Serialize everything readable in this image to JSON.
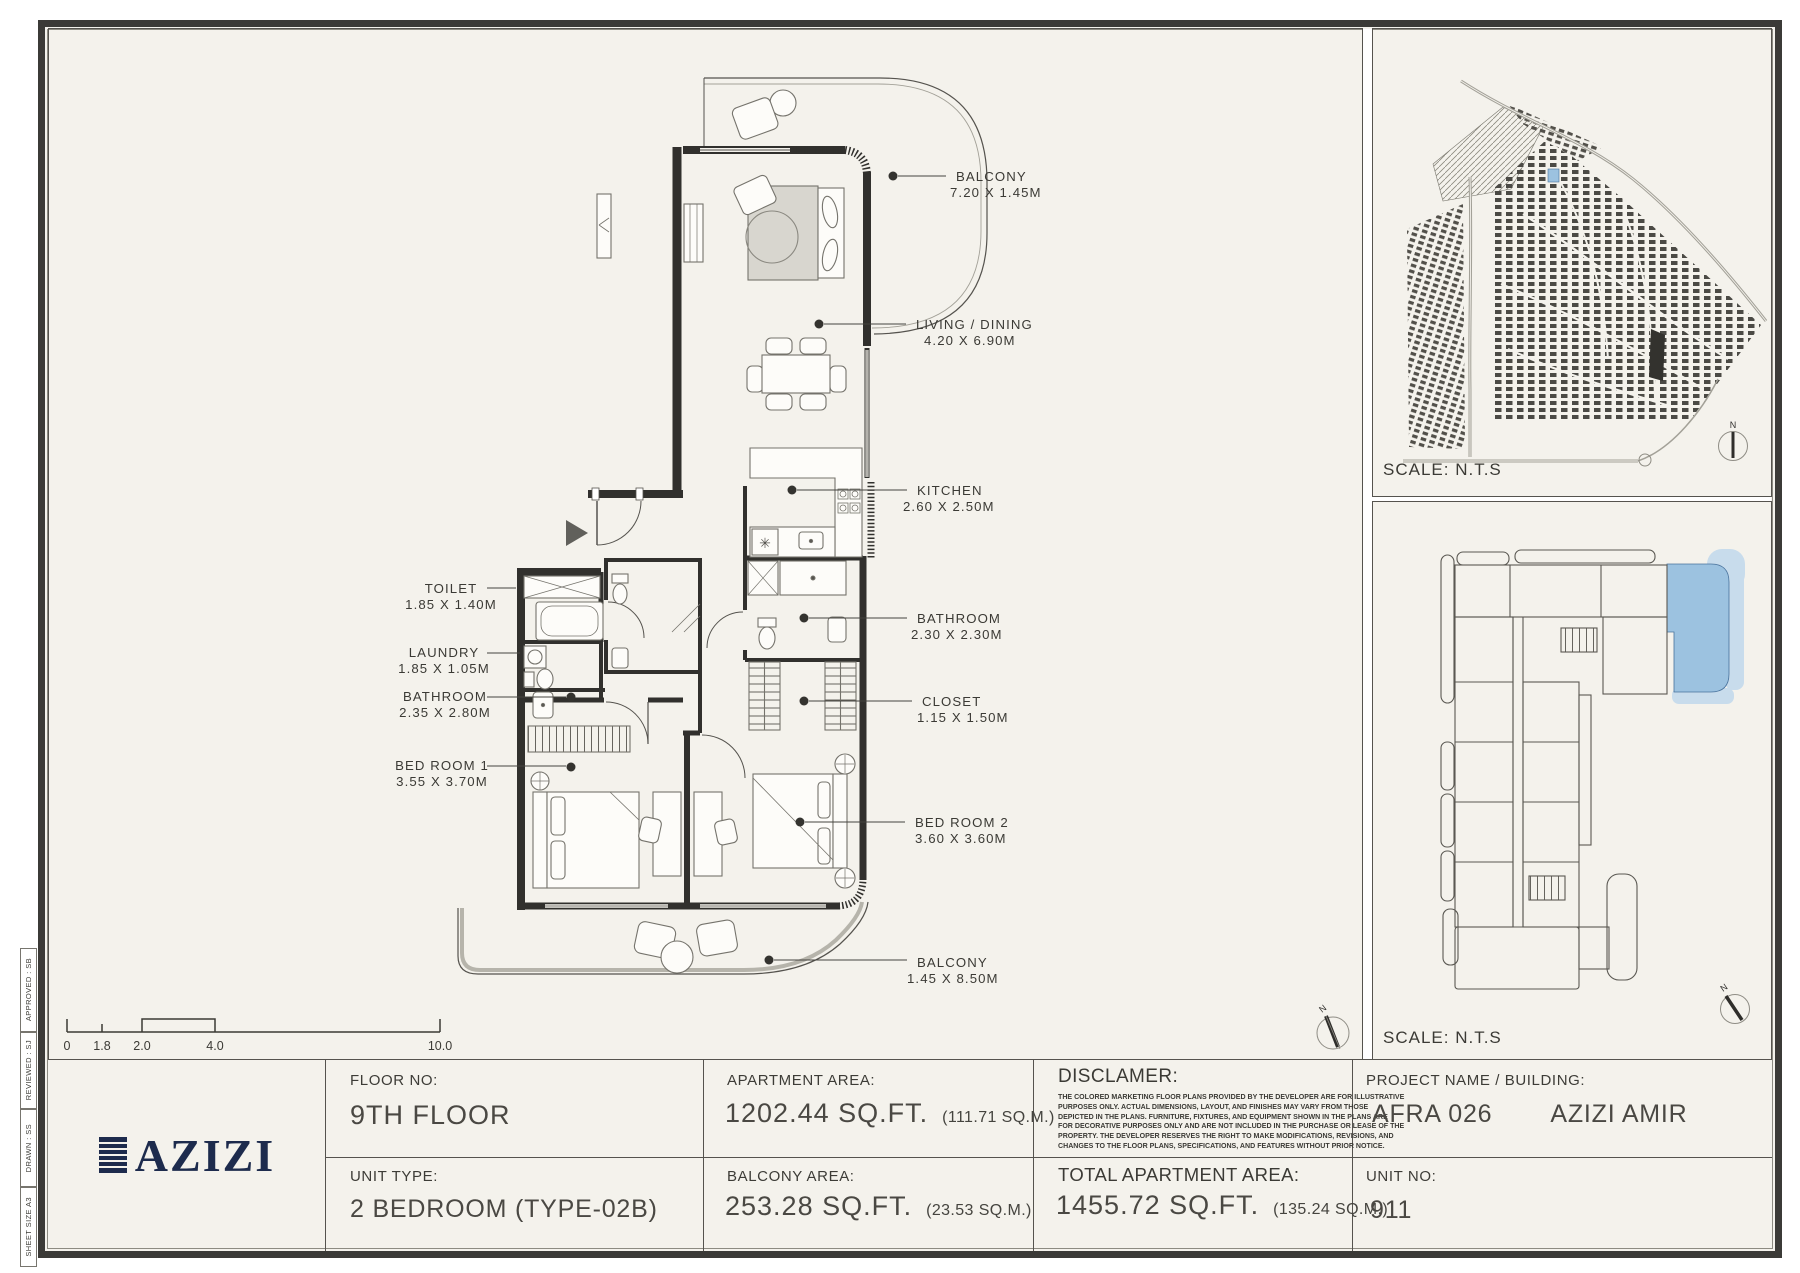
{
  "colors": {
    "logo_navy": "#1d2b4d",
    "unit_highlight_blue": "#9cc2e0",
    "unit_highlight_light_blue": "#c8dcec",
    "sheet_background": "#f4f2ec"
  },
  "sheet_meta": {
    "items": [
      "APPROVED : SB",
      "REVIEWED : SJ",
      "DRAWN : SS",
      "SHEET SIZE A3"
    ]
  },
  "floor_plan": {
    "labels": [
      {
        "name": "TOILET",
        "dims": "1.85 X 1.40M"
      },
      {
        "name": "LAUNDRY",
        "dims": "1.85 X 1.05M"
      },
      {
        "name": "BATHROOM",
        "dims": "2.35 X 2.80M"
      },
      {
        "name": "BED ROOM 1",
        "dims": "3.55 X 3.70M"
      },
      {
        "name": "BALCONY",
        "dims": "7.20 X 1.45M"
      },
      {
        "name": "LIVING / DINING",
        "dims": "4.20 X 6.90M"
      },
      {
        "name": "KITCHEN",
        "dims": "2.60 X 2.50M"
      },
      {
        "name": "BATHROOM",
        "dims": "2.30 X 2.30M"
      },
      {
        "name": "CLOSET",
        "dims": "1.15 X 1.50M"
      },
      {
        "name": "BED ROOM 2",
        "dims": "3.60 X 3.60M"
      },
      {
        "name": "BALCONY",
        "dims": "1.45 X 8.50M"
      }
    ],
    "scale_ticks": [
      "0",
      "1.8",
      "2.0",
      "4.0",
      "10.0"
    ],
    "compass_n": "N"
  },
  "site_map": {
    "scale_label": "SCALE: N.T.S",
    "compass_n": "N"
  },
  "key_plan": {
    "scale_label": "SCALE: N.T.S",
    "compass_n": "N"
  },
  "title_block": {
    "logo_text": "AZIZI",
    "floor": {
      "label": "FLOOR NO:",
      "value": "9TH FLOOR"
    },
    "unit_type": {
      "label": "UNIT TYPE:",
      "value": "2 BEDROOM (TYPE-02B)"
    },
    "apartment_area": {
      "label": "APARTMENT AREA:",
      "value": "1202.44 SQ.FT.",
      "metric": "(111.71 SQ.M.)"
    },
    "balcony_area": {
      "label": "BALCONY AREA:",
      "value": "253.28 SQ.FT.",
      "metric": "(23.53 SQ.M.)"
    },
    "disclaimer": {
      "label": "DISCLAMER:",
      "lines": [
        "THE COLORED MARKETING FLOOR PLANS PROVIDED BY THE DEVELOPER ARE FOR ILLUSTRATIVE",
        "PURPOSES ONLY. ACTUAL DIMENSIONS, LAYOUT, AND FINISHES MAY VARY FROM THOSE",
        "DEPICTED IN THE PLANS. FURNITURE, FIXTURES, AND EQUIPMENT SHOWN IN THE PLANS ARE",
        "FOR DECORATIVE PURPOSES ONLY AND ARE NOT INCLUDED IN THE PURCHASE OR LEASE OF THE",
        "PROPERTY. THE DEVELOPER RESERVES THE RIGHT TO MAKE MODIFICATIONS, REVISIONS, AND",
        "CHANGES TO THE FLOOR PLANS, SPECIFICATIONS, AND FEATURES WITHOUT PRIOR NOTICE."
      ]
    },
    "total_area": {
      "label": "TOTAL APARTMENT AREA:",
      "value": "1455.72 SQ.FT.",
      "metric": "(135.24 SQ.M.)"
    },
    "project": {
      "label": "PROJECT NAME / BUILDING:",
      "name": "AFRA 026",
      "building": "AZIZI AMIR"
    },
    "unit_no": {
      "label": "UNIT NO:",
      "value": "911"
    }
  }
}
